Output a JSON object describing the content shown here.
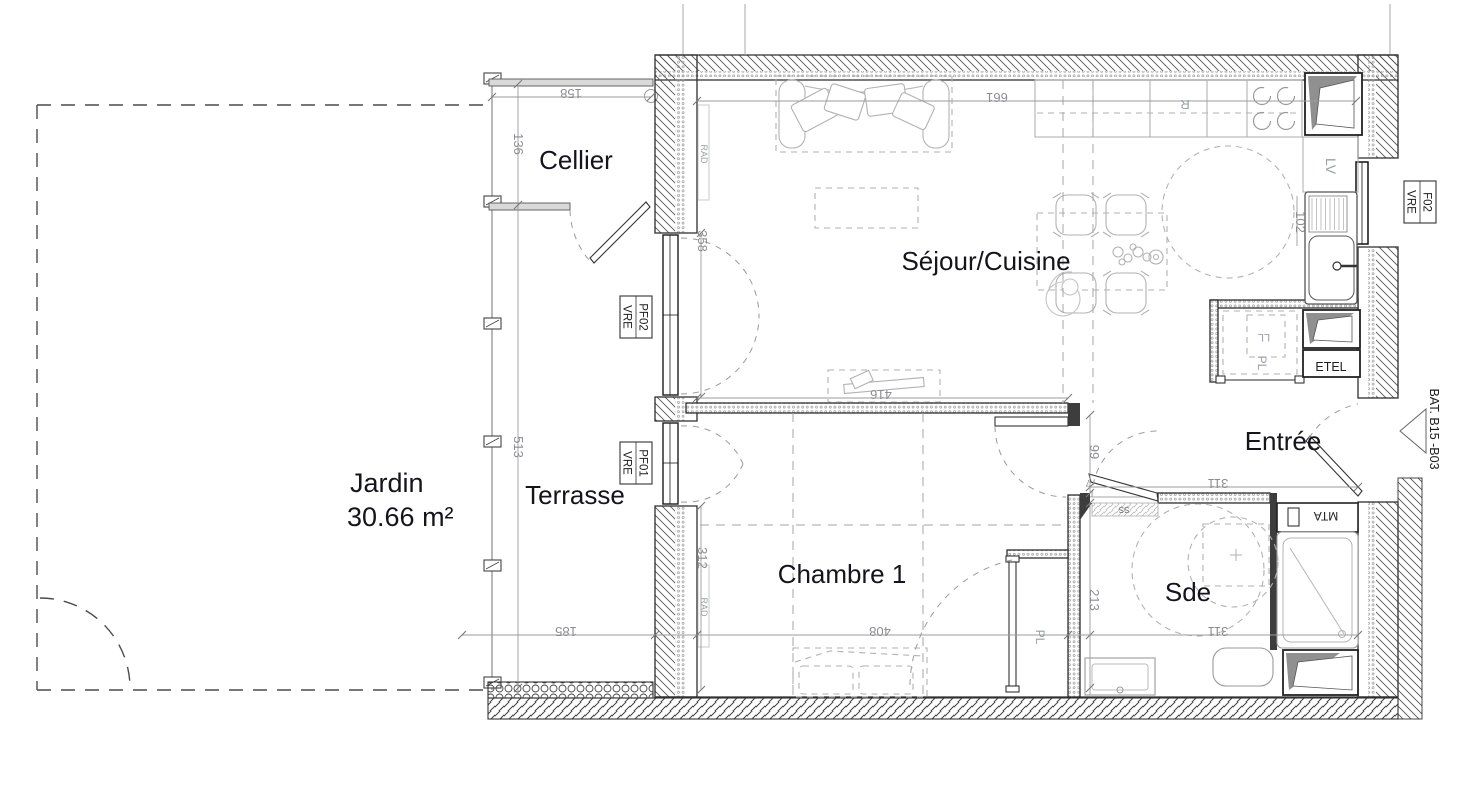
{
  "plan": {
    "rooms": {
      "jardin": {
        "name": "Jardin",
        "area": "30.66 m²"
      },
      "terrasse": "Terrasse",
      "cellier": "Cellier",
      "sejour": "Séjour/Cuisine",
      "chambre": "Chambre 1",
      "entree": "Entrée",
      "sde": "Sde"
    },
    "dims": {
      "cellier_w": "158",
      "cellier_h": "136",
      "terrasse_h": "513",
      "terrasse_w": "185",
      "sejour_w": "661",
      "window_w": "358",
      "inner_wall": "416",
      "chambre_wall": "312",
      "chambre_w": "408",
      "hall_h": "99",
      "sde_h": "213",
      "sde_w": "311",
      "entree_w": "311",
      "kitchen_col": "102",
      "jamb": "7"
    },
    "tags": {
      "rad": "RAD",
      "lv": "LV",
      "fridge": "R",
      "pl": "PL",
      "ll": "LL",
      "ss": "SS",
      "etel": "ETEL",
      "mta": "MTA"
    },
    "windows": {
      "pf02": {
        "code": "PF02",
        "type": "VRE"
      },
      "pf01": {
        "code": "PF01",
        "type": "VRE"
      },
      "f02": {
        "code": "F02",
        "type": "VRE"
      }
    },
    "building_ref": "BAT. B15 -B03",
    "colors": {
      "wall": "#3d3d3d",
      "dim_text": "#8c8c92",
      "furniture": "#b2b2b2",
      "label_text": "#14141c",
      "duct_fill": "#909090"
    }
  }
}
